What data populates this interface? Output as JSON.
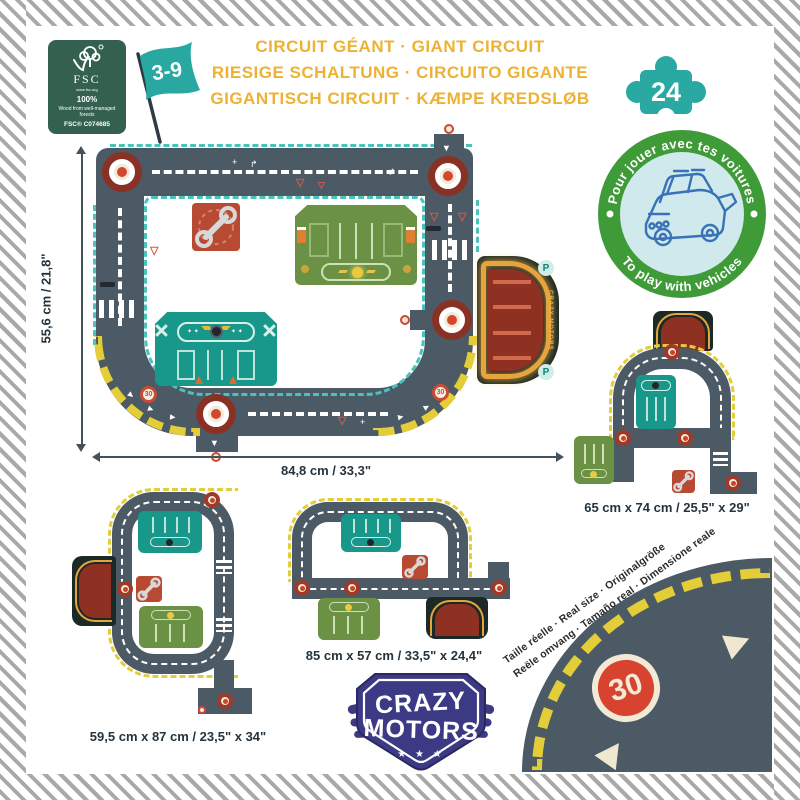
{
  "header": {
    "fsc": {
      "brand": "FSC",
      "site": "www.fsc.org",
      "percent": "100%",
      "claim": "Wood from well-managed forests",
      "license": "FSC® C074685"
    },
    "age_range": "3-9",
    "titles": [
      "CIRCUIT GÉANT · GIANT CIRCUIT",
      "RIESIGE SCHALTUNG · CIRCUITO GIGANTE",
      "GIGANTISCH CIRCUIT · KÆMPE KREDSLØB"
    ],
    "piece_count": "24"
  },
  "badge": {
    "arc_top": "Pour jouer avec tes voitures",
    "arc_bottom": "To play with vehicles"
  },
  "main_layout": {
    "height_label": "55,6 cm / 21,8\"",
    "width_label": "84,8 cm / 33,3\"",
    "speed_badge": "30",
    "parking_brand": "CRAZY MOTORS",
    "parking_letter": "P"
  },
  "alt_layouts": [
    {
      "id": "right",
      "label": "65 cm x 74 cm / 25,5\" x 29\""
    },
    {
      "id": "bottom_left",
      "label": "59,5 cm x 87 cm / 23,5\" x 34\""
    },
    {
      "id": "bottom_middle",
      "label": "85 cm x 57 cm / 33,5\" x 24,4\""
    }
  ],
  "brand": {
    "line1": "CRAZY",
    "line2": "MOTORS",
    "stars": "★ ★ ★"
  },
  "real_size": {
    "line1": "Taille réelle · Real size · Originalgröße",
    "line2": "Reële omvang · Tamaño real · Dimensione reale",
    "sign": "30"
  },
  "colors": {
    "title": "#edb233",
    "road": "#4b5a64",
    "teal_edge": "#49c4bd",
    "hazard_yellow": "#e3cd39",
    "badge_ring": "#3f9b37",
    "badge_bg": "#cfe9ed",
    "piece_teal": "#2aa8a2",
    "fsc_green": "#33604f",
    "logo_indigo": "#3c3a85",
    "parking_red": "#8e3123",
    "station_green": "#6b9145",
    "garage_teal": "#18988a"
  }
}
